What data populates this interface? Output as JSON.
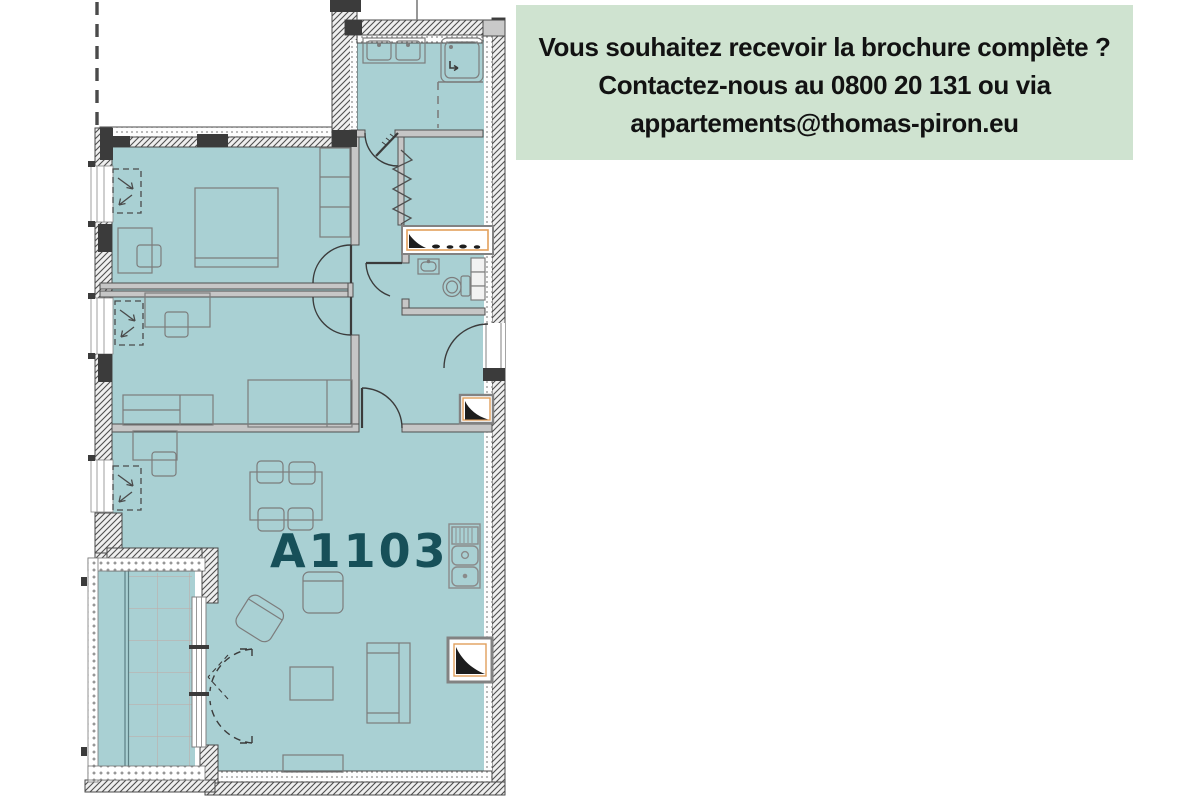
{
  "banner": {
    "lines": [
      "Vous souhaitez recevoir la brochure complète ?",
      "Contactez-nous au 0800 20 131 ou via",
      "appartements@thomas-piron.eu"
    ],
    "phone": "0800 20 131",
    "email": "appartements@thomas-piron.eu",
    "bg_color": "#cfe3d0",
    "text_color": "#121212"
  },
  "plan": {
    "apartment_label": "A1103",
    "label_color": "#175059",
    "floor_color": "#a9d0d3",
    "wall_dark": "#3b3b3b",
    "shaft_accent": "#e2a05c"
  }
}
